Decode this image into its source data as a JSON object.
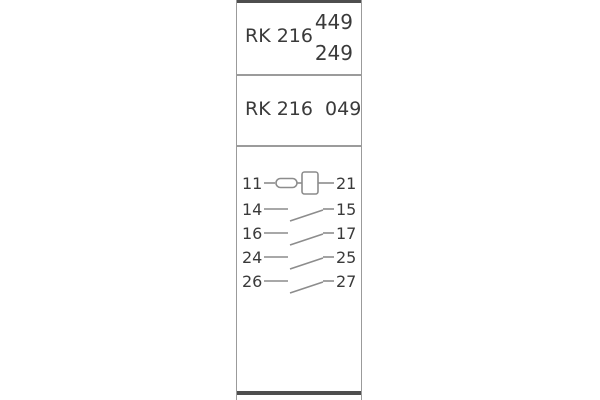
{
  "panel": {
    "section_top": {
      "model": "RK 216",
      "code_upper": "449",
      "code_lower": "249"
    },
    "section_middle": {
      "label": "RK 216  049"
    },
    "diagram": {
      "coil_row": {
        "left_terminal": "11",
        "right_terminal": "21"
      },
      "contact_rows": [
        {
          "left_terminal": "14",
          "right_terminal": "15"
        },
        {
          "left_terminal": "16",
          "right_terminal": "17"
        },
        {
          "left_terminal": "24",
          "right_terminal": "25"
        },
        {
          "left_terminal": "26",
          "right_terminal": "27"
        }
      ]
    }
  },
  "colors": {
    "background": "#ffffff",
    "panel_border": "#9b9b9b",
    "end_bar": "#4e4e4e",
    "text": "#3a3a3a",
    "diagram_line": "#8c8c8c"
  }
}
